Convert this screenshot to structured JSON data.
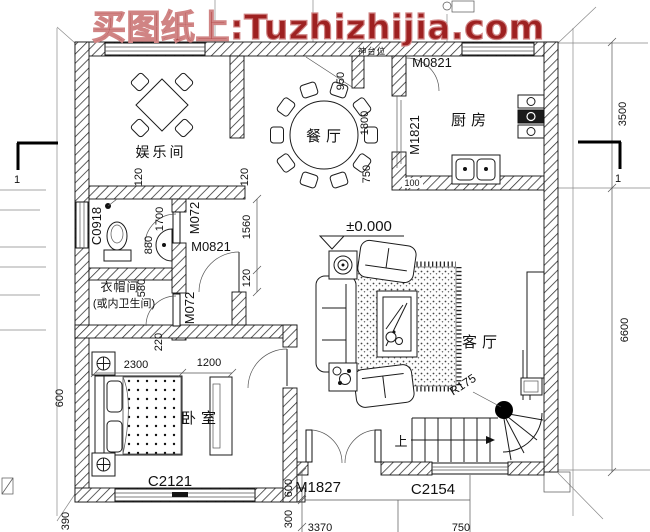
{
  "watermark": {
    "text": "买图纸上:Tuzhizhijia.com",
    "color": "#9e2121"
  },
  "rooms": {
    "entertainment": "娱乐间",
    "dining": "餐厅",
    "kitchen": "厨房",
    "living": "客厅",
    "bedroom": "卧室",
    "cloakroom_line1": "衣帽间",
    "cloakroom_line2": "(或内卫生间)",
    "altar": "神台位"
  },
  "labels": {
    "door_top": "M0821",
    "door_kitchen": "M1821",
    "door_hall": "M0821",
    "door_bath": "M072",
    "door_cloak": "M072",
    "window_bath": "C0918",
    "window_bedroom": "C2121",
    "door_entry": "M1827",
    "window_stairs": "C2154"
  },
  "stairs": {
    "up_label": "上",
    "radius_label": "R175"
  },
  "elevation_label": "±0.000",
  "section_marks": {
    "left": "1",
    "right": "1"
  },
  "dims": {
    "right_top": "3500",
    "right_bottom": "6600",
    "niche": "950",
    "dining_kitchen": "1800",
    "kitchen_side": "750",
    "bath_len": "1700",
    "bath_w": "880",
    "cloak_w": "580",
    "cloak_d": "220",
    "hall": "1560",
    "off_a": "120",
    "off_b": "120",
    "off_c": "120",
    "bed": "2300",
    "wardrobe": "1200",
    "left_off": "600",
    "left_390": "390",
    "porch_a": "600",
    "porch_b": "300",
    "wall_100": "100",
    "bottom_a": "3370",
    "bottom_b": "750"
  }
}
